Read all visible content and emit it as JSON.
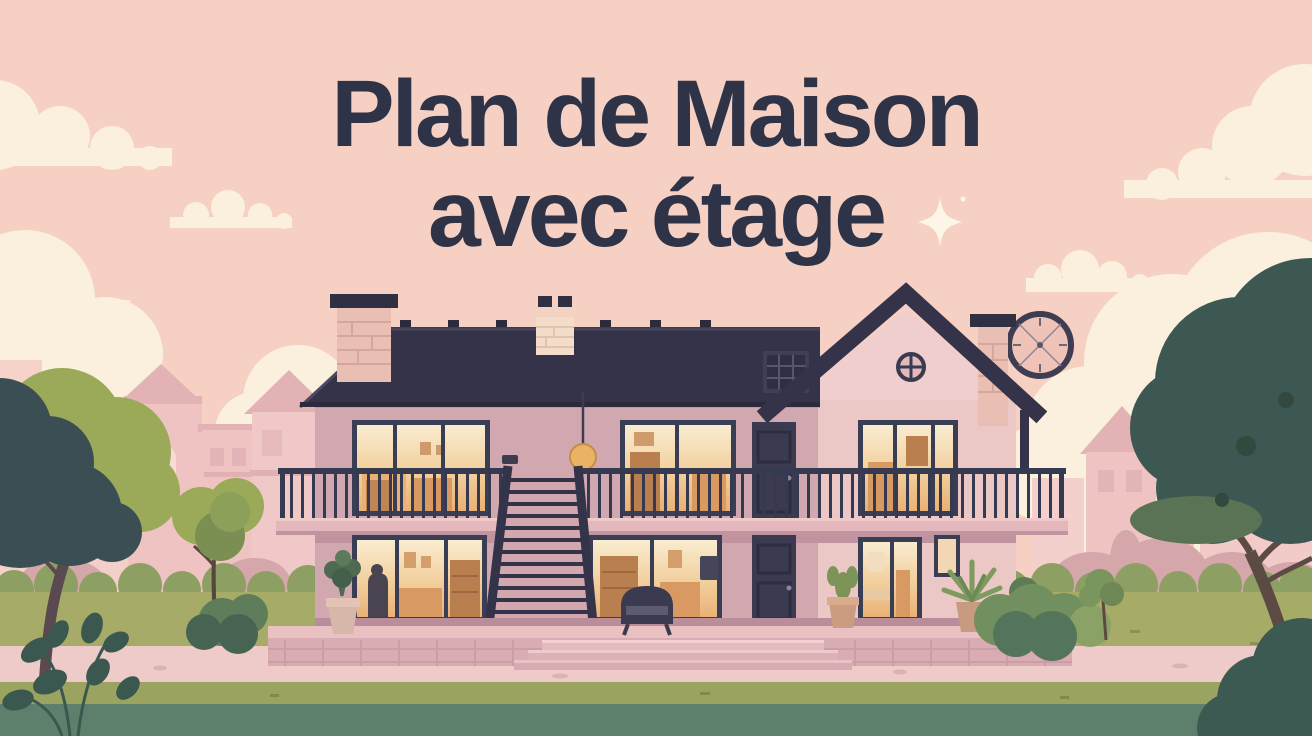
{
  "title": {
    "line1": "Plan de Maison",
    "line2": "avec étage"
  },
  "icons": {
    "sparkle": "✦"
  },
  "palette": {
    "sky": "#f6d1c3",
    "cream": "#faf0dd",
    "title": "#2e3348",
    "roof": "#34334a",
    "roofEdge": "#2c2b3d",
    "wall": "#d2a8b0",
    "wallLight": "#ebc7c6",
    "gable": "#f0cecd",
    "frame": "#3a3e55",
    "glowTop": "#f9ecd0",
    "glowMid": "#f2cf9c",
    "glowDeep": "#e9b176",
    "door": "#3b3a50",
    "railing": "#363a50",
    "slab": "#e3b7bb",
    "terrace": "#d8acb2",
    "terraceTop": "#e9c1c3",
    "brick": "#e9beb3",
    "brickPale": "#f4dcca",
    "cap": "#303043",
    "lawn": "#a6ab67",
    "lawnOlive": "#9aa35f",
    "path": "#eecbc9",
    "foreground": "#5d806c",
    "hedge": "#8d9f63",
    "treeOlive": "#9baa58",
    "treeDark": "#3d5752",
    "trunk": "#5a4a4c",
    "bgBuilding": "#eec3c2",
    "bgBuildingDark": "#e2b2b5",
    "shrubMauve": "#d5a7ab",
    "bushGreen": "#72905f",
    "bushDark": "#55745c",
    "amber": "#eab264",
    "clockFace": "#efc3b8",
    "interior": "#d89a62",
    "interiorDark": "#b97f4f"
  }
}
